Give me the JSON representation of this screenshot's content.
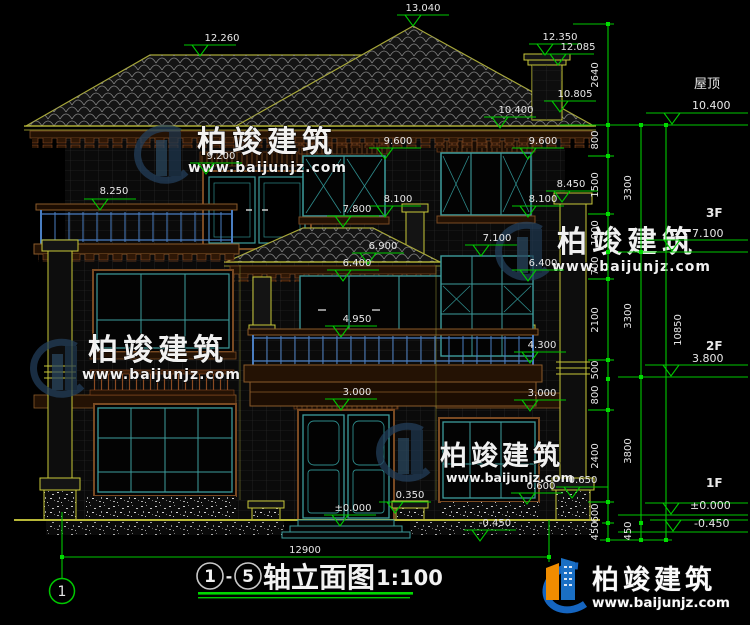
{
  "title": {
    "axis_start": "1",
    "separator": "-",
    "axis_end": "5",
    "name": "轴立面图",
    "scale": "1:100"
  },
  "axis": {
    "bubble_1": "1"
  },
  "watermark": {
    "brand": "柏竣建筑",
    "url": "www.baijunjz.com"
  },
  "logo": {
    "brand": "柏竣建筑",
    "url": "www.baijunjz.com"
  },
  "levels": {
    "roof_label": "屋顶",
    "roof_value": "10.400",
    "f3_label": "3F",
    "f3_value": "7.100",
    "f2_label": "2F",
    "f2_value": "3.800",
    "f1_label": "1F",
    "f1_value": "±0.000",
    "below_value": "-0.450"
  },
  "markers": {
    "ridge_left": "12.260",
    "ridge_main": "13.040",
    "chimney_top": "12.350",
    "chimney_cap": "12.085",
    "chimney_base": "10.805",
    "roof_slope": "10.400",
    "w3_left": "9.200",
    "balcony3": "8.250",
    "w3_center": "9.600",
    "w3_right": "9.600",
    "col_right_cap": "8.450",
    "sill3_center": "8.100",
    "sill3_right": "8.100",
    "bay_ridge": "7.800",
    "w2_right": "7.100",
    "bay_eave": "6.900",
    "bay_soffit_l": "6.400",
    "bay_soffit_r": "6.400",
    "balcony2": "4.950",
    "louver": "4.300",
    "slab2_c": "3.000",
    "slab2_r": "3.000",
    "pedestal_c": "0.350",
    "pedestal_r": "0.600",
    "col_right_base": "0.650",
    "door_sill": "±0.000",
    "ground": "-0.450"
  },
  "dims": {
    "c1": [
      "2640",
      "800",
      "1500",
      "1000",
      "700",
      "2100",
      "500",
      "800",
      "2400",
      "600",
      "450"
    ],
    "c2": [
      "3300",
      "3300",
      "3800",
      "450"
    ],
    "c3": [
      "10850"
    ],
    "width": "12900"
  },
  "colors": {
    "dim_green": "#00c800",
    "line_yellow": "#b8b838",
    "window_teal": "#3d9c9c",
    "trim_brown": "#7a4a22",
    "rail_blue": "#4a7ec2",
    "logo_blue": "#1a6fc4",
    "logo_orange": "#f08c00"
  }
}
